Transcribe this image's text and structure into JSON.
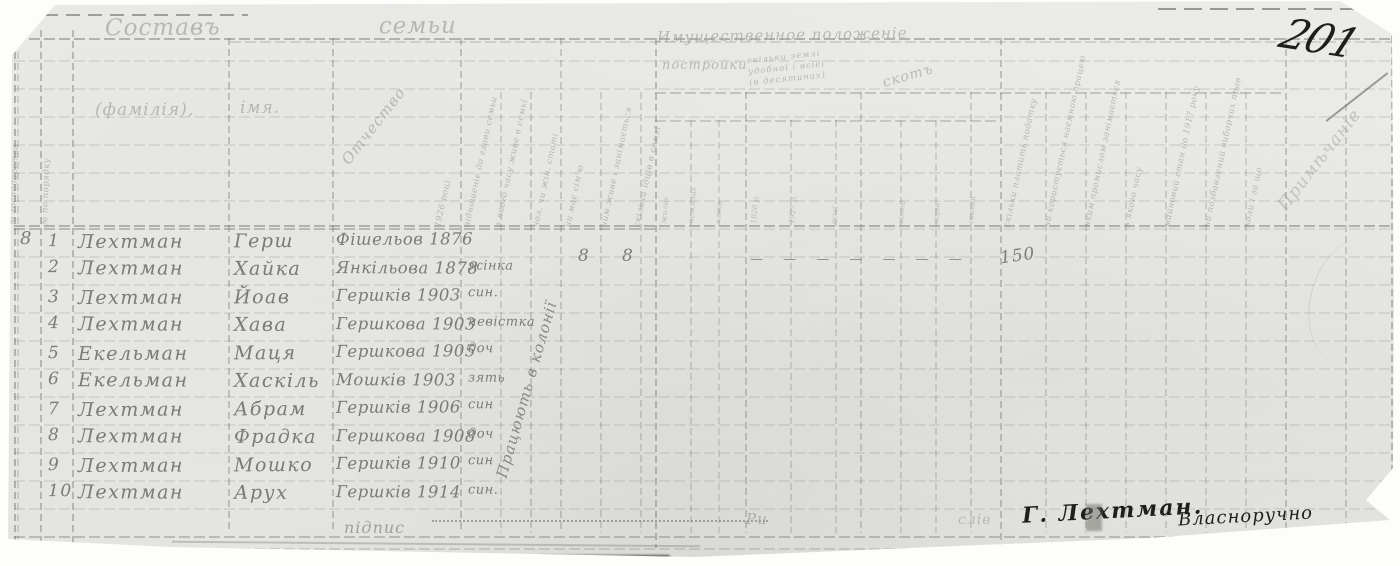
{
  "header": {
    "page_number": "201",
    "family_section": "Составъ семьи",
    "property_section": "Имущественное положеніе",
    "remarks": "Примѣчаніе",
    "col_surname": "(фамілія),",
    "col_name": "імя.",
    "col_patronymic": "Отчество",
    "left_cols": [
      "№ господарства",
      "№ по порядку"
    ],
    "rotated_left": [
      "1926 році",
      "відношеніе до глави семьи",
      "з якого часу живе в семьї",
      "чол. чи жін. статі",
      "чи має сім'ю",
      "чим живе і занімається",
      "скільки їдців в семьї"
    ],
    "buildings_title": "постройки",
    "buildings_subs": [
      "жилих",
      "нежилих",
      "хлівів"
    ],
    "land_title": "скільки землі удобної і всієї (в десятинах)",
    "land_subs": [
      "1926 р.",
      "1927 р.",
      "всієї"
    ],
    "livestock_title": "скотъ",
    "livestock_subs": [
      "коней",
      "корів",
      "свиней"
    ],
    "rotated_right": [
      "скільки платить податку",
      "чи користується наємною працею",
      "яким промислом занімається",
      "з якого часу",
      "майновий стан до 1917 року",
      "чи позбавлений виборчих прав",
      "коли і за що"
    ]
  },
  "body": {
    "group_number": "8",
    "rows": [
      {
        "num": "1",
        "surname": "Лехтман",
        "name": "Герш",
        "origin": "Фішельов 1876",
        "relation": ""
      },
      {
        "num": "2",
        "surname": "Лехтман",
        "name": "Хайка",
        "origin": "Янкільова 1878",
        "relation": "жінка"
      },
      {
        "num": "3",
        "surname": "Лехтман",
        "name": "Йоав",
        "origin": "Гершків 1903",
        "relation": "син."
      },
      {
        "num": "4",
        "surname": "Лехтман",
        "name": "Хава",
        "origin": "Гершкова 1903",
        "relation": "невістка"
      },
      {
        "num": "5",
        "surname": "Екельман",
        "name": "Маця",
        "origin": "Гершкова 1905",
        "relation": "доч"
      },
      {
        "num": "6",
        "surname": "Екельман",
        "name": "Хаскіль",
        "origin": "Мошків 1903",
        "relation": "зять"
      },
      {
        "num": "7",
        "surname": "Лехтман",
        "name": "Абрам",
        "origin": "Гершків 1906",
        "relation": "син"
      },
      {
        "num": "8",
        "surname": "Лехтман",
        "name": "Фрадка",
        "origin": "Гершкова 1908",
        "relation": "доч"
      },
      {
        "num": "9",
        "surname": "Лехтман",
        "name": "Мошко",
        "origin": "Гершків 1910",
        "relation": "син"
      },
      {
        "num": "10",
        "surname": "Лехтман",
        "name": "Арух",
        "origin": "Гершків 1914",
        "relation": "син."
      }
    ],
    "family_counts": [
      "8",
      "8"
    ],
    "row2_dashes": "—   —   —   —   —   —   —",
    "row2_value": "150",
    "work_note": "Працюють в колонії"
  },
  "footer": {
    "label": "підпис",
    "mark": "Ри",
    "pencil": "слів",
    "signature_name": "Г. Лехтман.",
    "signature_word": "Власноручно"
  }
}
